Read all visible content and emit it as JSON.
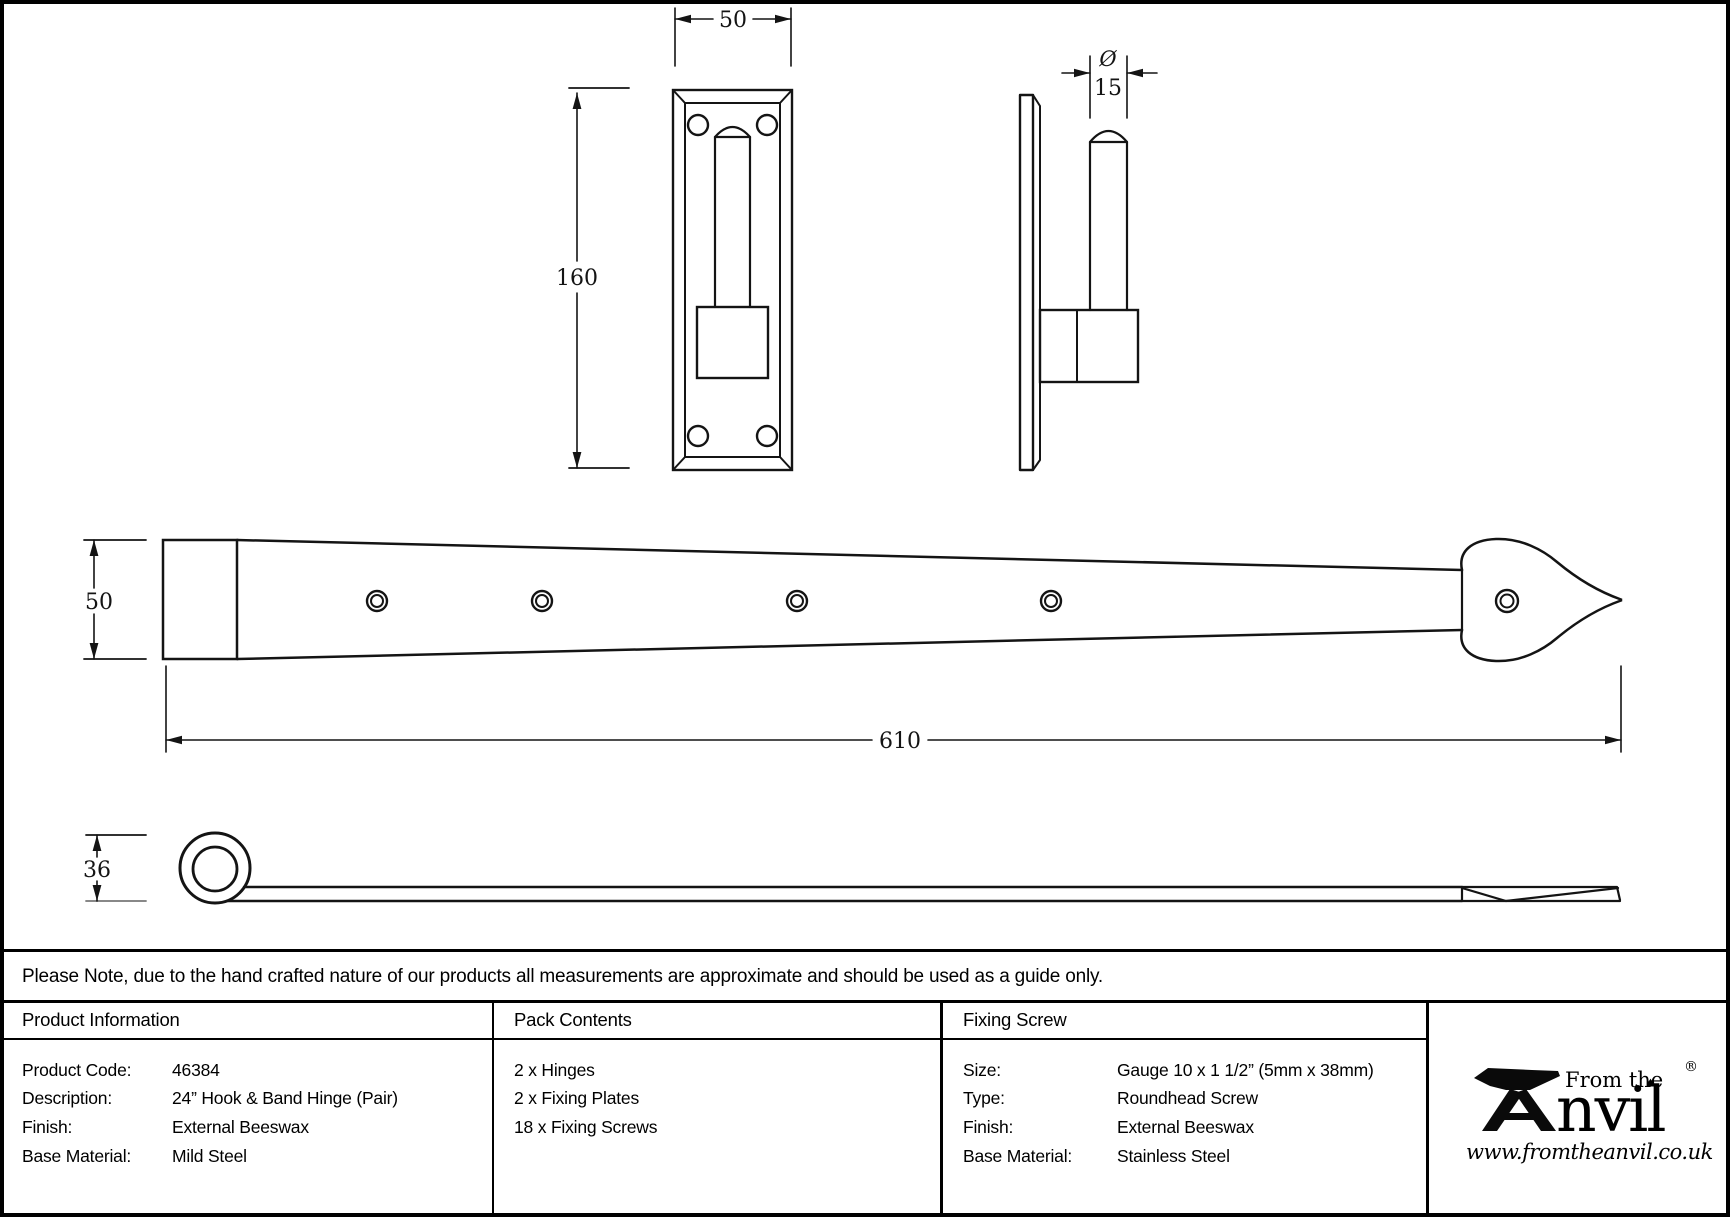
{
  "dimensions": {
    "plate_front": {
      "width": "50",
      "height": "160"
    },
    "pin_side": {
      "dia_symbol": "Ø",
      "dia_value": "15"
    },
    "band_front": {
      "width": "50",
      "length": "610"
    },
    "band_side": {
      "height": "36"
    }
  },
  "note": "Please Note, due to the hand crafted nature of our products all measurements are approximate and should be used as a guide only.",
  "table": {
    "product_information": {
      "title": "Product Information",
      "rows": [
        {
          "label": "Product Code:",
          "value": "46384"
        },
        {
          "label": "Description:",
          "value": "24” Hook & Band Hinge (Pair)"
        },
        {
          "label": "Finish:",
          "value": "External Beeswax"
        },
        {
          "label": "Base Material:",
          "value": "Mild Steel"
        }
      ]
    },
    "pack_contents": {
      "title": "Pack Contents",
      "items": [
        "2 x Hinges",
        "2 x Fixing Plates",
        "18 x Fixing Screws"
      ]
    },
    "fixing_screw": {
      "title": "Fixing Screw",
      "rows": [
        {
          "label": "Size:",
          "value": "Gauge 10 x 1 1/2” (5mm x 38mm)"
        },
        {
          "label": "Type:",
          "value": "Roundhead Screw"
        },
        {
          "label": "Finish:",
          "value": "External Beeswax"
        },
        {
          "label": "Base Material:",
          "value": "Stainless Steel"
        }
      ]
    },
    "brand": {
      "tagline": "From the",
      "diamond": "♦",
      "name": "nvil",
      "full_name": "Anvil",
      "registered": "®",
      "website": "www.fromtheanvil.co.uk"
    }
  },
  "colors": {
    "line": "#141414",
    "background": "#ffffff"
  }
}
